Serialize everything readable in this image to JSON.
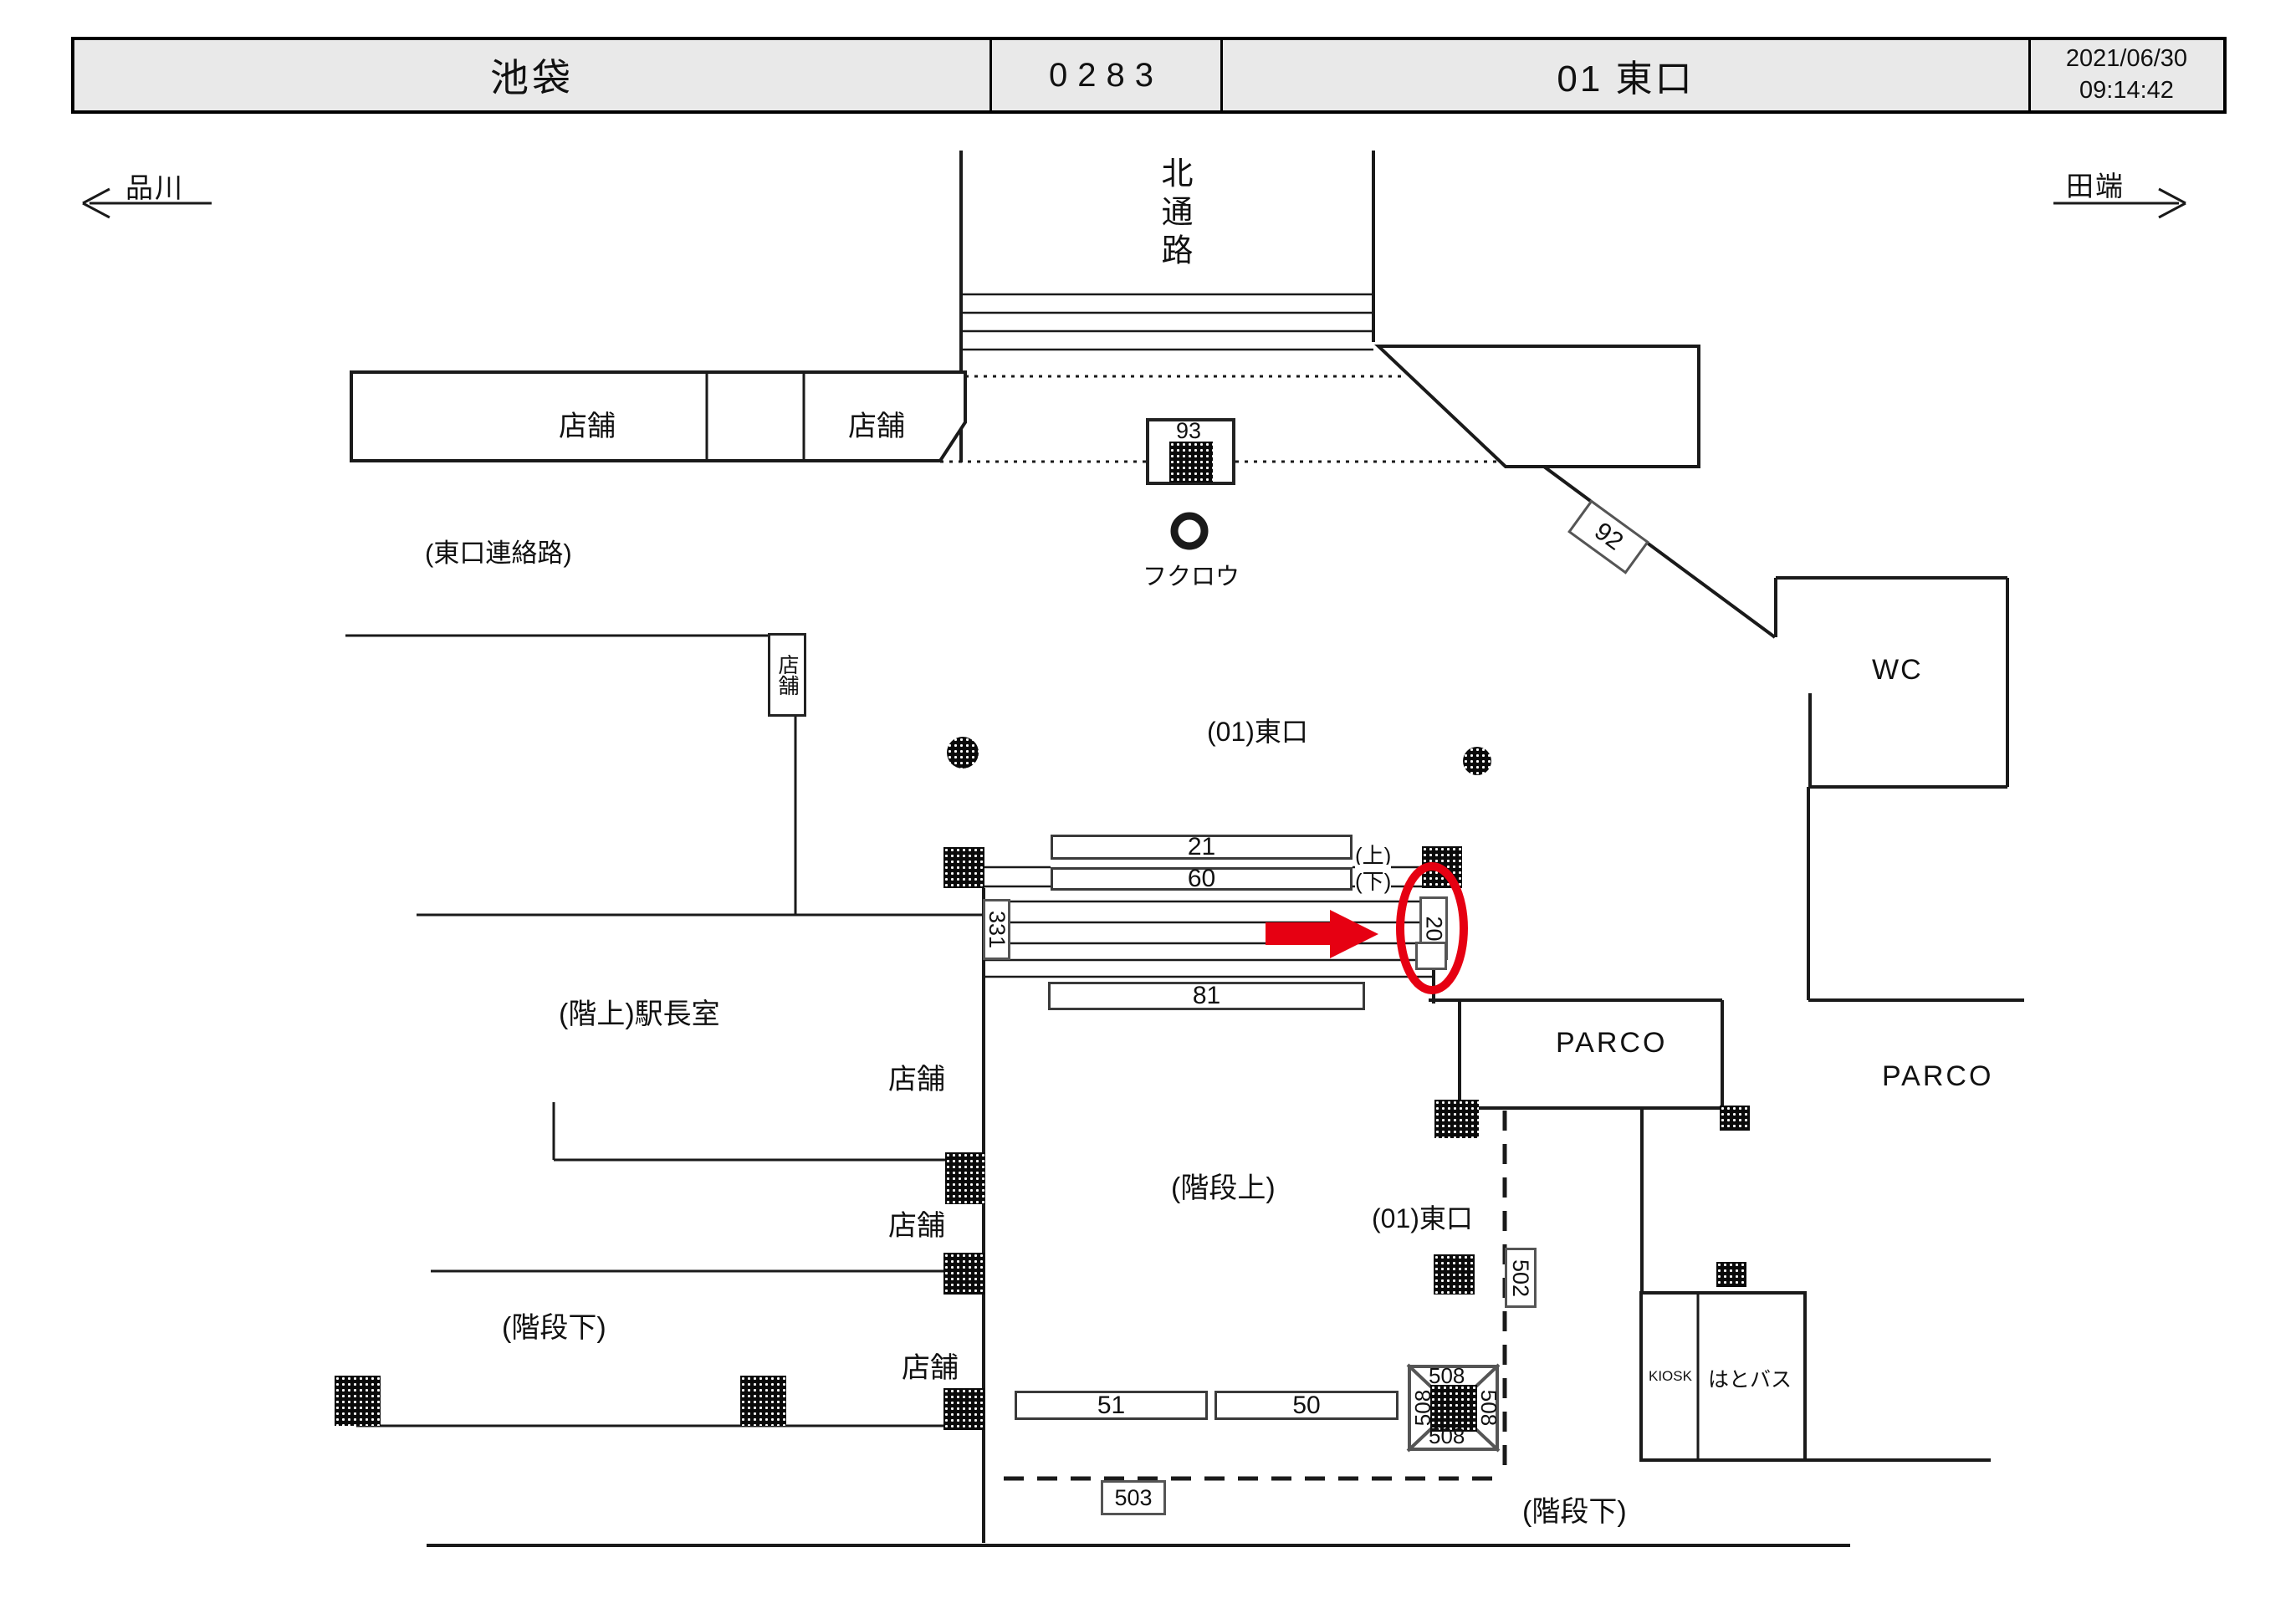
{
  "header": {
    "station": "池袋",
    "code": "0283",
    "screen": "01 東口",
    "date": "2021/06/30",
    "time": "09:14:42"
  },
  "directions": {
    "left": "品川",
    "right": "田端"
  },
  "areas": {
    "north_passage": "北通路",
    "east_connecting": "(東口連絡路)",
    "owl": "フクロウ",
    "wc": "WC",
    "east_exit": "(01)東口",
    "stationmaster_upstairs": "(階上)駅長室",
    "parco": "PARCO",
    "stairs_up": "(階段上)",
    "stairs_down": "(階段下)",
    "kiosk": "KIOSK",
    "hatobus": "はとバス",
    "shop": "店舗",
    "up": "(上)",
    "down": "(下)"
  },
  "tags": {
    "t93": "93",
    "t92": "92",
    "t21": "21",
    "t60": "60",
    "t331": "331",
    "t20": "20",
    "t81": "81",
    "t51": "51",
    "t50": "50",
    "t508": "508",
    "t502": "502",
    "t503": "503"
  },
  "highlight": {
    "selected_tag": "20",
    "marker_color": "#e60012"
  },
  "colors": {
    "line": "#1a1a1a",
    "header_bg": "#e9e9e9",
    "red": "#e60012"
  }
}
